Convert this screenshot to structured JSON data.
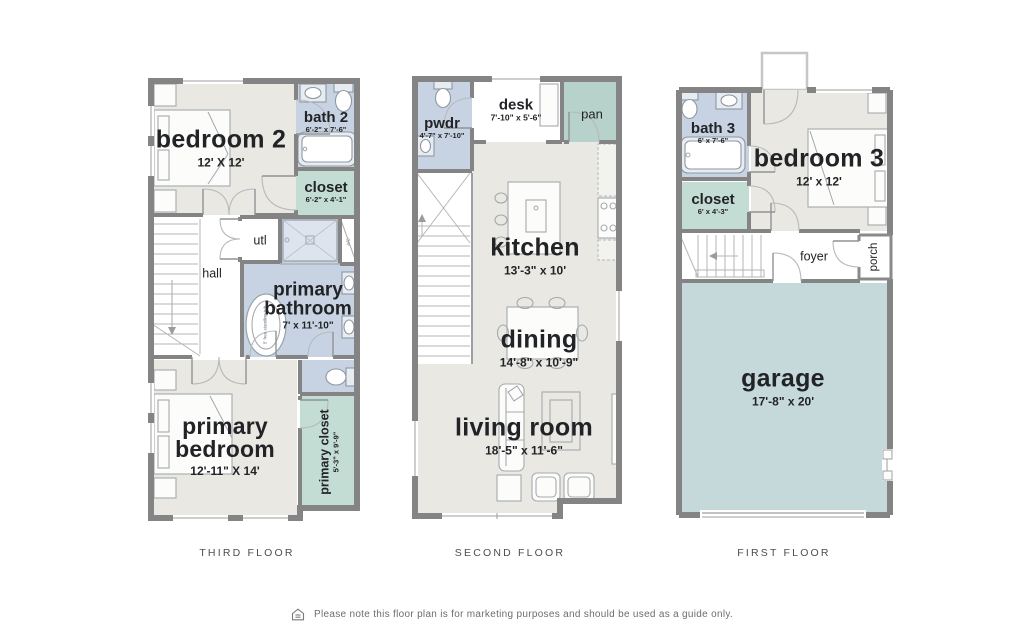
{
  "colors": {
    "wall": "#848484",
    "room": "#e9e8e3",
    "bath": "#c7d3e2",
    "teal": "#c3dcd4",
    "pan": "#b7d1cb",
    "garage": "#c6d9da",
    "ink": "#222326",
    "caption": "#4e4e4e",
    "muted": "#6d6d6d"
  },
  "floors": {
    "third": {
      "caption": "THIRD FLOOR",
      "rooms": {
        "bedroom2": {
          "name": "bedroom 2",
          "dims": "12' X 12'"
        },
        "bath2": {
          "name": "bath 2",
          "dims": "6'-2\" x 7'-6\""
        },
        "closet": {
          "name": "closet",
          "dims": "6'-2\" x 4'-1\""
        },
        "hall": {
          "name": "hall"
        },
        "utl": {
          "name": "utl"
        },
        "ac": {
          "name": "A/C"
        },
        "tub": {
          "name": "5' free standing tub"
        },
        "primary_bathroom": {
          "line1": "primary",
          "line2": "bathroom",
          "dims": "7' x 11'-10\""
        },
        "primary_bedroom": {
          "line1": "primary",
          "line2": "bedroom",
          "dims": "12'-11\" X 14'"
        },
        "primary_closet": {
          "name": "primary closet",
          "dims": "5'-3\" x 9'-9\""
        }
      }
    },
    "second": {
      "caption": "SECOND FLOOR",
      "rooms": {
        "pwdr": {
          "name": "pwdr",
          "dims": "4'-7\" x 7'-10\""
        },
        "desk": {
          "name": "desk",
          "dims": "7'-10\" x 5'-6\""
        },
        "pan": {
          "name": "pan"
        },
        "kitchen": {
          "name": "kitchen",
          "dims": "13'-3\" x 10'"
        },
        "dining": {
          "name": "dining",
          "dims": "14'-8\" x 10'-9\""
        },
        "living": {
          "name": "living room",
          "dims": "18'-5\" x 11'-6\""
        }
      }
    },
    "first": {
      "caption": "FIRST FLOOR",
      "rooms": {
        "bath3": {
          "name": "bath 3",
          "dims": "6' x 7'-6\""
        },
        "bedroom3": {
          "name": "bedroom 3",
          "dims": "12' x 12'"
        },
        "closet": {
          "name": "closet",
          "dims": "6' x 4'-3\""
        },
        "foyer": {
          "name": "foyer"
        },
        "porch": {
          "name": "porch"
        },
        "garage": {
          "name": "garage",
          "dims": "17'-8\" x 20'"
        }
      }
    }
  },
  "footer": {
    "icon": "house-icon",
    "disclaimer": "Please note this floor plan is for marketing purposes and should be used as a guide only."
  }
}
